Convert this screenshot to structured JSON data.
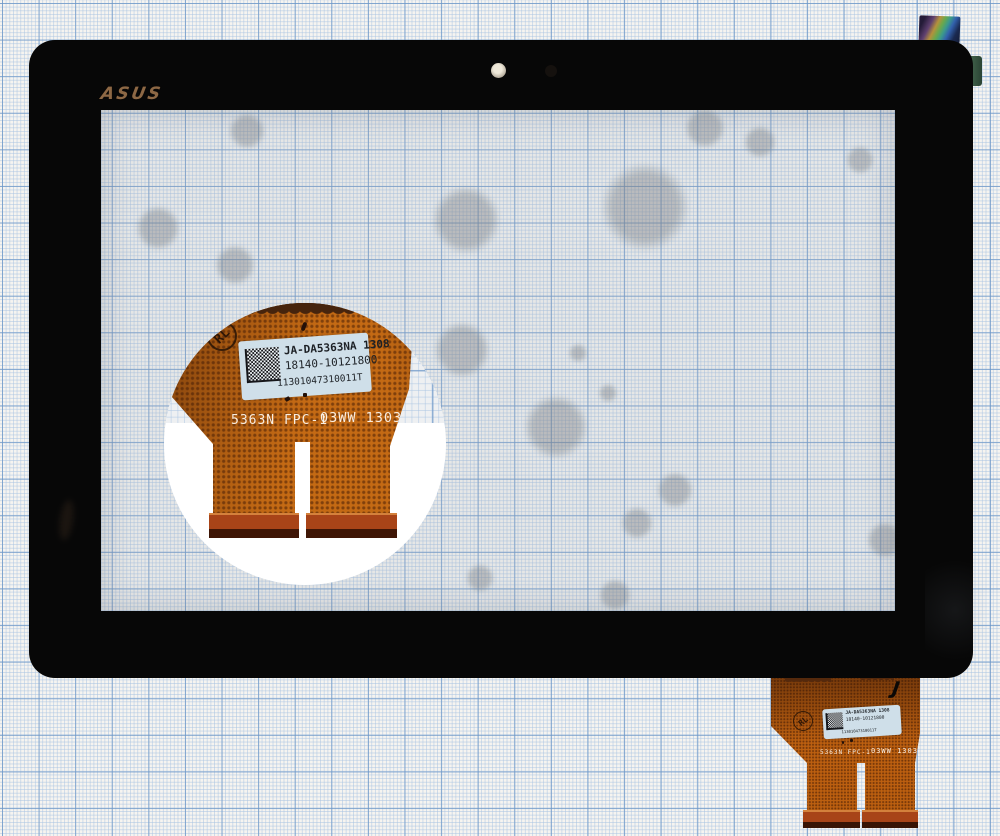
{
  "photo": {
    "subject": "ASUS tablet touchscreen digitizer glass lying on blue graph paper",
    "brand_logo": "ASUS"
  },
  "labels": {
    "part_label": {
      "line1": "JA-DA5363NA 1308",
      "line2": "18140-10121800",
      "line3": "11301047310011T"
    },
    "flex_print_left": "5363N FPC-1",
    "flex_print_right": "03WW 1303",
    "rl_mark": "RL",
    "handwritten_mark": "J"
  },
  "colors": {
    "flex_copper": "#bd6010",
    "connector_bar": "#a84418",
    "label_bg": "#cfdfe9",
    "bezel_black": "#070707",
    "paper_grid_major": "#6e98c8",
    "paper_grid_minor": "#a8c3e2",
    "logo_bronze": "#8d6845",
    "holo_sticker_green": "#6aa84c",
    "holo_sticker_blue": "#3261ad"
  }
}
